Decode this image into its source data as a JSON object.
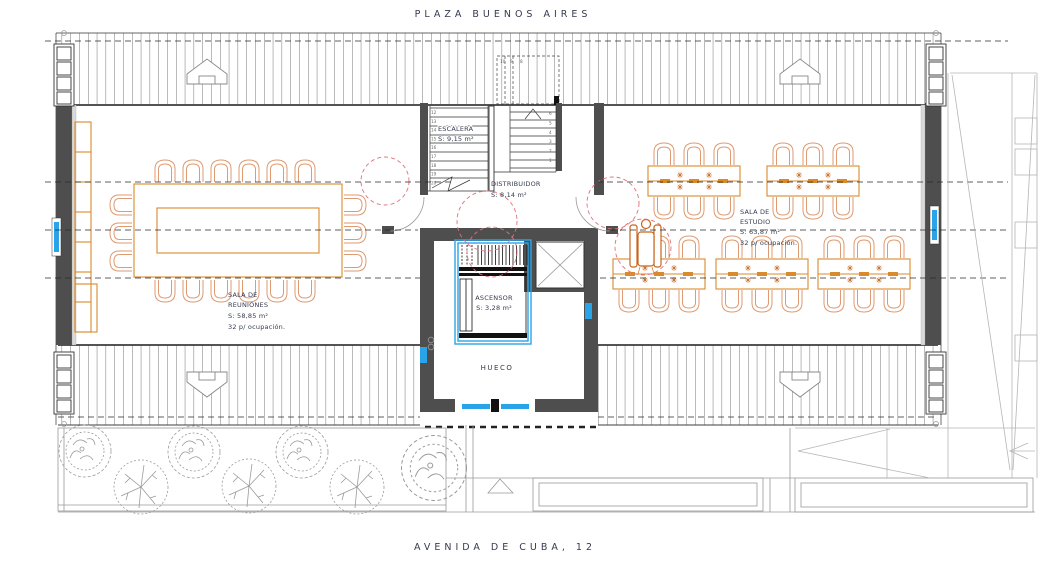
{
  "title": {
    "top": "PLAZA BUENOS AIRES",
    "bottom": "AVENIDA DE CUBA, 12"
  },
  "rooms": {
    "escalera": {
      "name": "ESCALERA",
      "area": "S: 9,15 m²"
    },
    "distribuidor": {
      "name": "DISTRIBUIDOR",
      "area": "S: 8,14 m²"
    },
    "sala_reuniones": {
      "name_line1": "SALA DE",
      "name_line2": "REUNIONES",
      "area": "S: 58,85 m²",
      "occupancy": "32 p/ ocupación."
    },
    "sala_estudio": {
      "name_line1": "SALA DE",
      "name_line2": "ESTUDIO",
      "area": "S: 63,87 m²",
      "occupancy": "32 p/ ocupación."
    },
    "ascensor": {
      "name": "ASCENSOR",
      "area": "S: 3,28 m²"
    },
    "hueco": {
      "name": "HUECO"
    }
  },
  "stair": {
    "left_step_numbers": [
      "12",
      "13",
      "14",
      "15",
      "16",
      "17",
      "18",
      "19",
      "20"
    ],
    "right_step_numbers": [
      "6",
      "5",
      "4",
      "3",
      "2",
      "1"
    ],
    "upper_step_numbers": [
      "10",
      "9",
      "8"
    ]
  },
  "colors": {
    "wall": "#4e4e4e",
    "furniture": "#d98a2b",
    "chair": "#de9a70",
    "grid_pink": "#e0707a",
    "accent_blue": "#2aa4e8",
    "site_gray": "#9a9a9a",
    "text": "#353b50"
  }
}
